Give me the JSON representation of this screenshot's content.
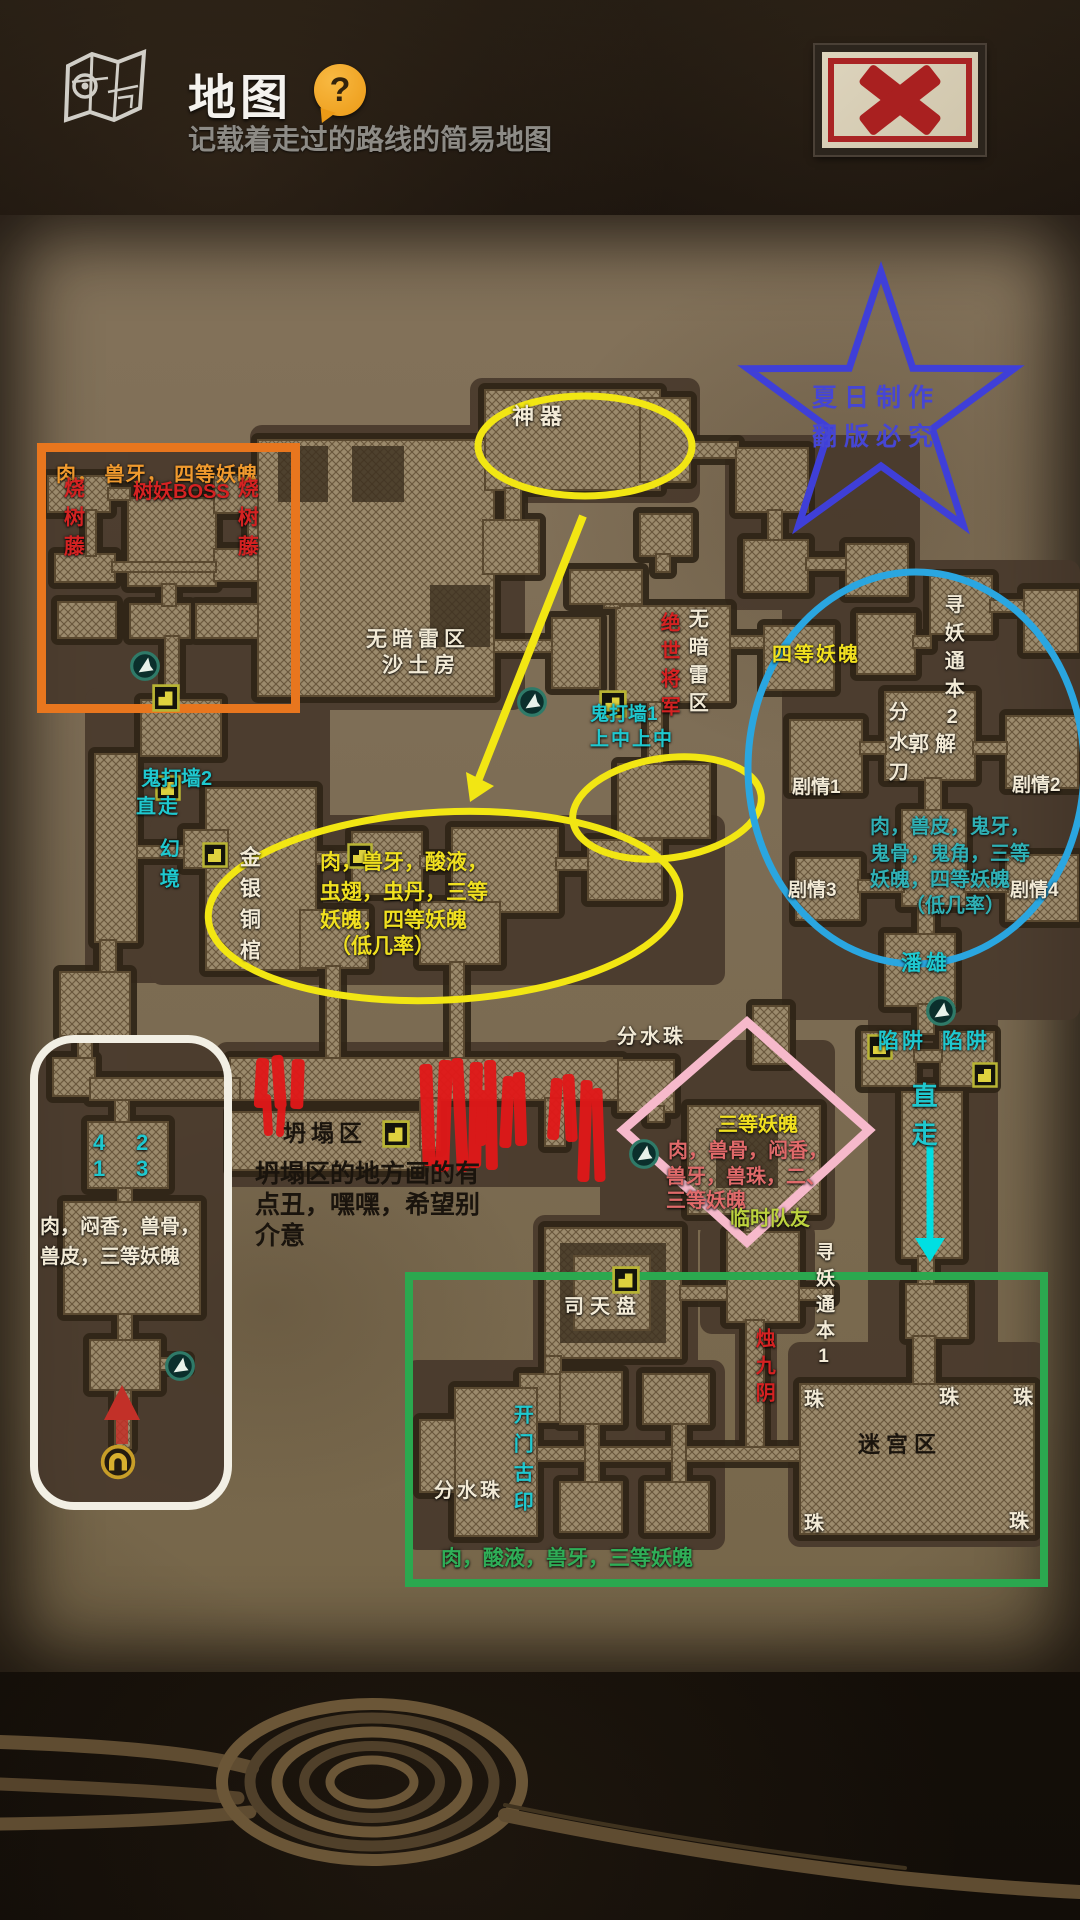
{
  "header": {
    "title": "地图",
    "subtitle": "记载着走过的路线的简易地图",
    "help_glyph": "?"
  },
  "watermark": {
    "line1": "夏日制作",
    "line2": "翻版必究"
  },
  "labels": {
    "orange_drops": "肉， 兽牙， 四等妖魄",
    "tree_boss": "树妖BOSS",
    "vine": "烧树藤",
    "artifact": "神器",
    "sand_line1": "无暗雷区",
    "sand_line2": "沙土房",
    "general_v": "绝世将军",
    "no_mine_v": "无暗雷区",
    "ghost_wall1": "鬼打墙1",
    "ghost_wall1_hint": "上中上中",
    "tier4": "四等妖魄",
    "quest2_v": "寻妖通本2",
    "water_knife_v": "分水刀",
    "guo_jie": "郭解",
    "plot1": "剧情1",
    "plot2": "剧情2",
    "plot3": "剧情3",
    "plot4": "剧情4",
    "circle_drops_l1": "肉，兽皮，鬼牙，",
    "circle_drops_l2": "鬼骨，鬼角，三等",
    "circle_drops_l3": "妖魄，四等妖魄",
    "circle_drops_l4": "（低几率）",
    "pan_xiong": "潘雄",
    "trap": "陷阱",
    "go_straight": "直走",
    "ghost_wall2": "鬼打墙2",
    "illusion_v": "幻境",
    "coffin_v": "金银铜棺",
    "ellipse_drops_l1": "肉，兽牙，酸液，",
    "ellipse_drops_l2": "虫翅，虫丹，三等",
    "ellipse_drops_l3": "妖魄，四等妖魄",
    "ellipse_drops_l4": "（低几率）",
    "water_pearl_top": "分水珠",
    "diamond_tier": "三等妖魄",
    "diamond_drops_l1": "肉，兽骨，闷香，",
    "diamond_drops_l2": "兽牙，兽珠，二、",
    "diamond_drops_l3": "三等妖魄",
    "temp_ally": "临时队友",
    "quest1_v": "寻妖通本1",
    "zhu_jiu_yin_v": "烛九阴",
    "si_tian_pan": "司天盘",
    "door_seal_v": "开门古印",
    "water_pearl_bottom": "分水珠",
    "green_drops": "肉，酸液，兽牙，三等妖魄",
    "maze": "迷宫区",
    "pearl": "珠",
    "collapse_title": "坍塌区",
    "collapse_note_l1": "坍塌区的地方画的有",
    "collapse_note_l2": "点丑，嘿嘿，希望别",
    "collapse_note_l3": "介意",
    "num1": "1",
    "num2": "2",
    "num3": "3",
    "num4": "4",
    "white_drops_l1": "肉，闷香，兽骨，",
    "white_drops_l2": "兽皮，三等妖魄"
  },
  "colors": {
    "orange_box": "#e8761e",
    "white_box": "#f2efe4",
    "green_box": "#2ba84f",
    "blue_circle": "#2aa6e0",
    "yellow_marker": "#f2e613",
    "pink_diamond": "#f6b9cb",
    "cyan_arrow": "#00dfe2",
    "red_marks": "#e11818",
    "star_blue": "#3f3fd8"
  },
  "icons": {
    "map": "map-sketch",
    "help": "question-bubble",
    "close": "red-x-stamp",
    "transfer": "footprint-circle",
    "stairs": "stairs-block",
    "exit": "arch-circle",
    "up_arrow": "red-up-arrow"
  }
}
